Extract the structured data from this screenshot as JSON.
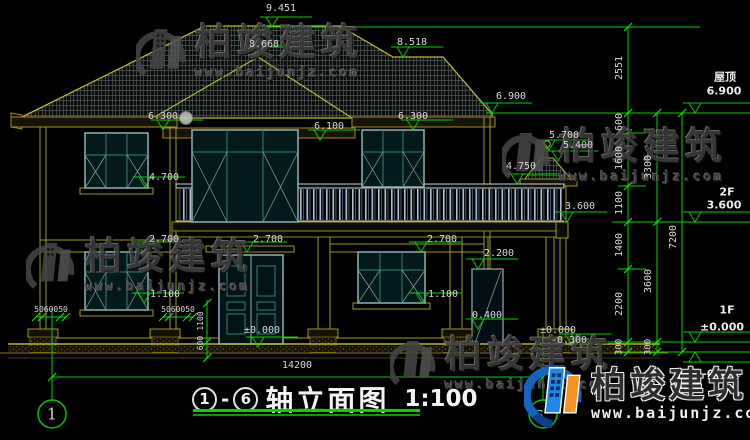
{
  "drawing_title": {
    "axis_start": "1",
    "axis_end": "6",
    "name": "轴立面图",
    "scale": "1:100"
  },
  "brand": {
    "name": "柏竣建筑",
    "url": "www.baijunjz.com"
  },
  "colors": {
    "dim_green": "#00d400",
    "line_yellow": "#9d9d1c",
    "window_teal": "#35807f",
    "text_gray": "#d9d9d9",
    "underline_green": "#00d800"
  },
  "overall_width_dim": "14200",
  "floor_labels": [
    "屋顶",
    "2F",
    "1F"
  ],
  "annotations": [
    {
      "t": "9.451",
      "x": 281,
      "y": 9,
      "tip": [
        272,
        27
      ]
    },
    {
      "t": "8.668",
      "x": 264,
      "y": 45,
      "tip": [
        258,
        57
      ]
    },
    {
      "t": "8.518",
      "x": 412,
      "y": 43,
      "tip": [
        403,
        57
      ]
    },
    {
      "t": "6.900",
      "x": 511,
      "y": 97,
      "tip": [
        492,
        113
      ]
    },
    {
      "t": "6.300",
      "x": 163,
      "y": 117,
      "tip": [
        163,
        130
      ]
    },
    {
      "t": "6.100",
      "x": 329,
      "y": 127,
      "tip": [
        320,
        140
      ]
    },
    {
      "t": "6.300",
      "x": 413,
      "y": 117,
      "tip": [
        413,
        130
      ]
    },
    {
      "t": "5.700",
      "x": 564,
      "y": 136,
      "tip": [
        549,
        150
      ]
    },
    {
      "t": "5.400",
      "x": 578,
      "y": 146,
      "tip": [
        558,
        161
      ]
    },
    {
      "t": "4.750",
      "x": 521,
      "y": 167,
      "tip": [
        517,
        184
      ]
    },
    {
      "t": "4.700",
      "x": 164,
      "y": 178,
      "tip": [
        145,
        187
      ]
    },
    {
      "t": "3.600",
      "x": 580,
      "y": 207,
      "tip": [
        567,
        222
      ]
    },
    {
      "t": "2.700",
      "x": 164,
      "y": 240,
      "tip": [
        143,
        252
      ]
    },
    {
      "t": "2.700",
      "x": 268,
      "y": 240,
      "tip": [
        247,
        252
      ]
    },
    {
      "t": "2.700",
      "x": 442,
      "y": 240,
      "tip": [
        421,
        252
      ]
    },
    {
      "t": "2.200",
      "x": 499,
      "y": 254,
      "tip": [
        478,
        269
      ]
    },
    {
      "t": "1.100",
      "x": 165,
      "y": 295,
      "tip": [
        144,
        303
      ]
    },
    {
      "t": "1.100",
      "x": 443,
      "y": 295,
      "tip": [
        422,
        303
      ]
    },
    {
      "t": "0.400",
      "x": 487,
      "y": 316,
      "tip": [
        478,
        329
      ]
    },
    {
      "t": "±0.000",
      "x": 262,
      "y": 331,
      "tip": [
        258,
        347
      ]
    },
    {
      "t": "±0.000",
      "x": 558,
      "y": 331,
      "tip": [
        571,
        344
      ]
    },
    {
      "t": "-0.300",
      "x": 569,
      "y": 341,
      "tip": [
        584,
        352
      ]
    },
    {
      "t": "屋顶",
      "x": 725,
      "y": 77,
      "size": 11,
      "bright": true
    },
    {
      "t": "6.900",
      "x": 724,
      "y": 91,
      "size": 11,
      "bright": true,
      "tip": [
        695,
        113
      ],
      "lead": 55
    },
    {
      "t": "2F",
      "x": 727,
      "y": 192,
      "size": 11,
      "bright": true
    },
    {
      "t": "3.600",
      "x": 724,
      "y": 205,
      "size": 11,
      "bright": true,
      "tip": [
        695,
        222
      ],
      "lead": 55
    },
    {
      "t": "1F",
      "x": 727,
      "y": 310,
      "size": 11,
      "bright": true
    },
    {
      "t": "±0.000",
      "x": 722,
      "y": 327,
      "size": 11,
      "bright": true,
      "tip": [
        695,
        342
      ],
      "lead": 55
    },
    {
      "t": "-0.300",
      "x": 722,
      "y": 374,
      "size": 11,
      "bright": true,
      "tip": [
        695,
        352
      ],
      "lead": 55,
      "inv": true
    },
    {
      "t": "14200",
      "x": 297,
      "y": 366
    },
    {
      "t": "5060050",
      "x": 51,
      "y": 310,
      "size": 8
    },
    {
      "t": "5060050",
      "x": 178,
      "y": 310,
      "size": 8
    },
    {
      "t": "1100",
      "x": 201,
      "y": 321,
      "size": 8,
      "rot": true
    },
    {
      "t": "600",
      "x": 201,
      "y": 343,
      "size": 8,
      "rot": true
    },
    {
      "t": "2551",
      "x": 620,
      "y": 68,
      "rot": true
    },
    {
      "t": "600",
      "x": 620,
      "y": 122,
      "rot": true
    },
    {
      "t": "1600",
      "x": 620,
      "y": 158,
      "rot": true
    },
    {
      "t": "1100",
      "x": 620,
      "y": 203,
      "rot": true
    },
    {
      "t": "1400",
      "x": 620,
      "y": 245,
      "rot": true
    },
    {
      "t": "2200",
      "x": 620,
      "y": 304,
      "rot": true
    },
    {
      "t": "300",
      "x": 620,
      "y": 347,
      "size": 9,
      "rot": true
    },
    {
      "t": "3300",
      "x": 649,
      "y": 167,
      "rot": true
    },
    {
      "t": "3600",
      "x": 649,
      "y": 281,
      "rot": true
    },
    {
      "t": "300",
      "x": 649,
      "y": 347,
      "size": 9,
      "rot": true
    },
    {
      "t": "7200",
      "x": 674,
      "y": 237,
      "rot": true
    }
  ]
}
